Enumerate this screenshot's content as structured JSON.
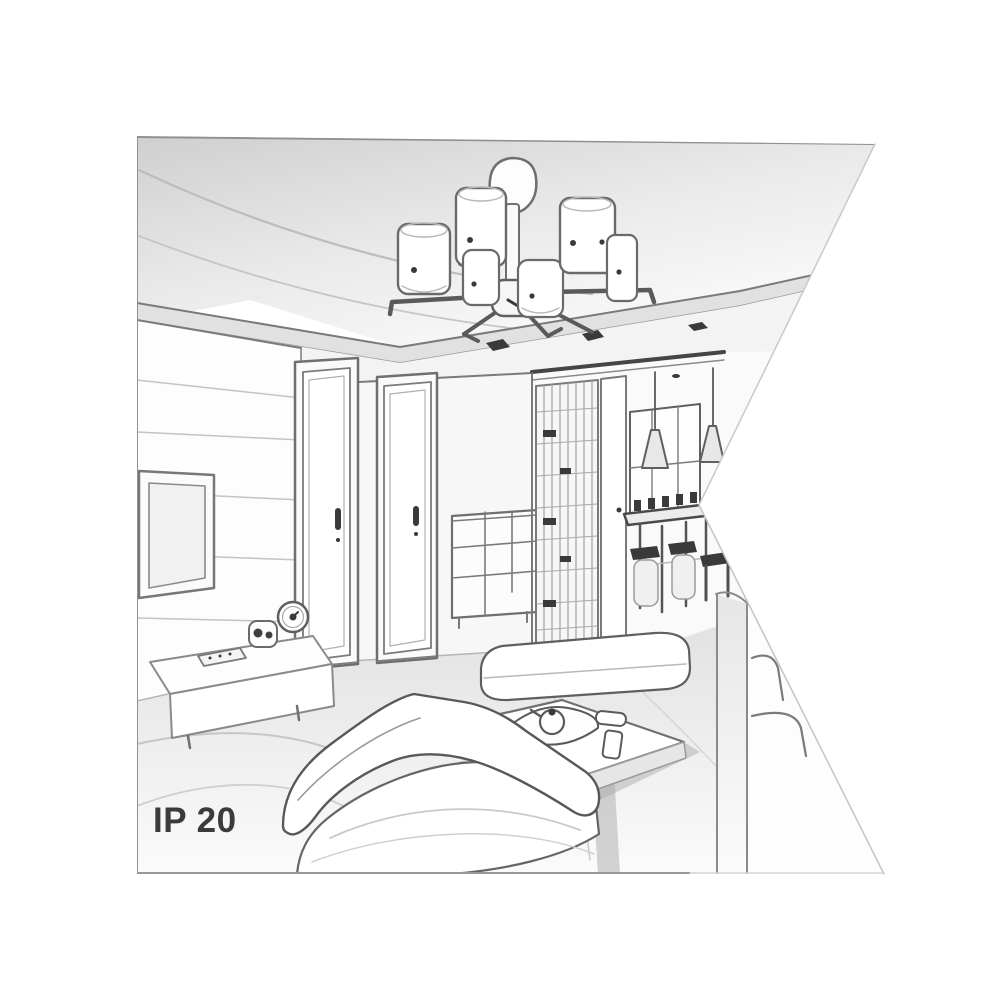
{
  "label": {
    "text": "IP 20"
  },
  "palette": {
    "background": "#ffffff",
    "line_dark": "#4f4f4f",
    "line_mid": "#7a7a7a",
    "line_soft": "#b9b9b9",
    "ink": "#3a3a3a",
    "fill_white": "#ffffff",
    "fill_light": "#f4f4f4",
    "fill_mid": "#e4e4e4",
    "text": "#3b3b3b"
  },
  "scene": {
    "type": "grayscale perspective line-art sketch of a modern living-room interior, right edge cut by a white triangular notch",
    "regions": [
      {
        "name": "ceiling",
        "details": "light-gray ceiling with sweeping cove curves and a stepped drop panel"
      },
      {
        "name": "chandelier",
        "details": "six cylindrical shades on radial arms around a central hub, stem and round canopy mounted on the drop panel"
      },
      {
        "name": "recessed-spotlights",
        "count": 3
      },
      {
        "name": "tv-wall",
        "details": "left wall with horizontal panel seams, wall-mounted TV in double frame"
      },
      {
        "name": "doors",
        "details": "two closed interior doors with dark handles"
      },
      {
        "name": "chest-of-drawers",
        "details": "small dresser with grid of drawers between door and corner"
      },
      {
        "name": "hallway",
        "details": "slatted wardrobe, narrow door, dark ceiling beam, window, two cone pendant lamps, dining table with chairs and two bar stools"
      },
      {
        "name": "sideboard",
        "details": "low media console with remote, small speaker and round clock on top"
      },
      {
        "name": "sofa",
        "details": "large sofa seen from behind with rolled backrest"
      },
      {
        "name": "coffee-table",
        "details": "low table with tray, teapot, plate and two cups"
      },
      {
        "name": "ottoman",
        "details": "white bench behind the coffee table"
      },
      {
        "name": "armchair-right",
        "details": "second sofa arm and chair outlines clipped by the white notch"
      },
      {
        "name": "floor",
        "details": "light floor with sweeping rug lines"
      }
    ]
  }
}
